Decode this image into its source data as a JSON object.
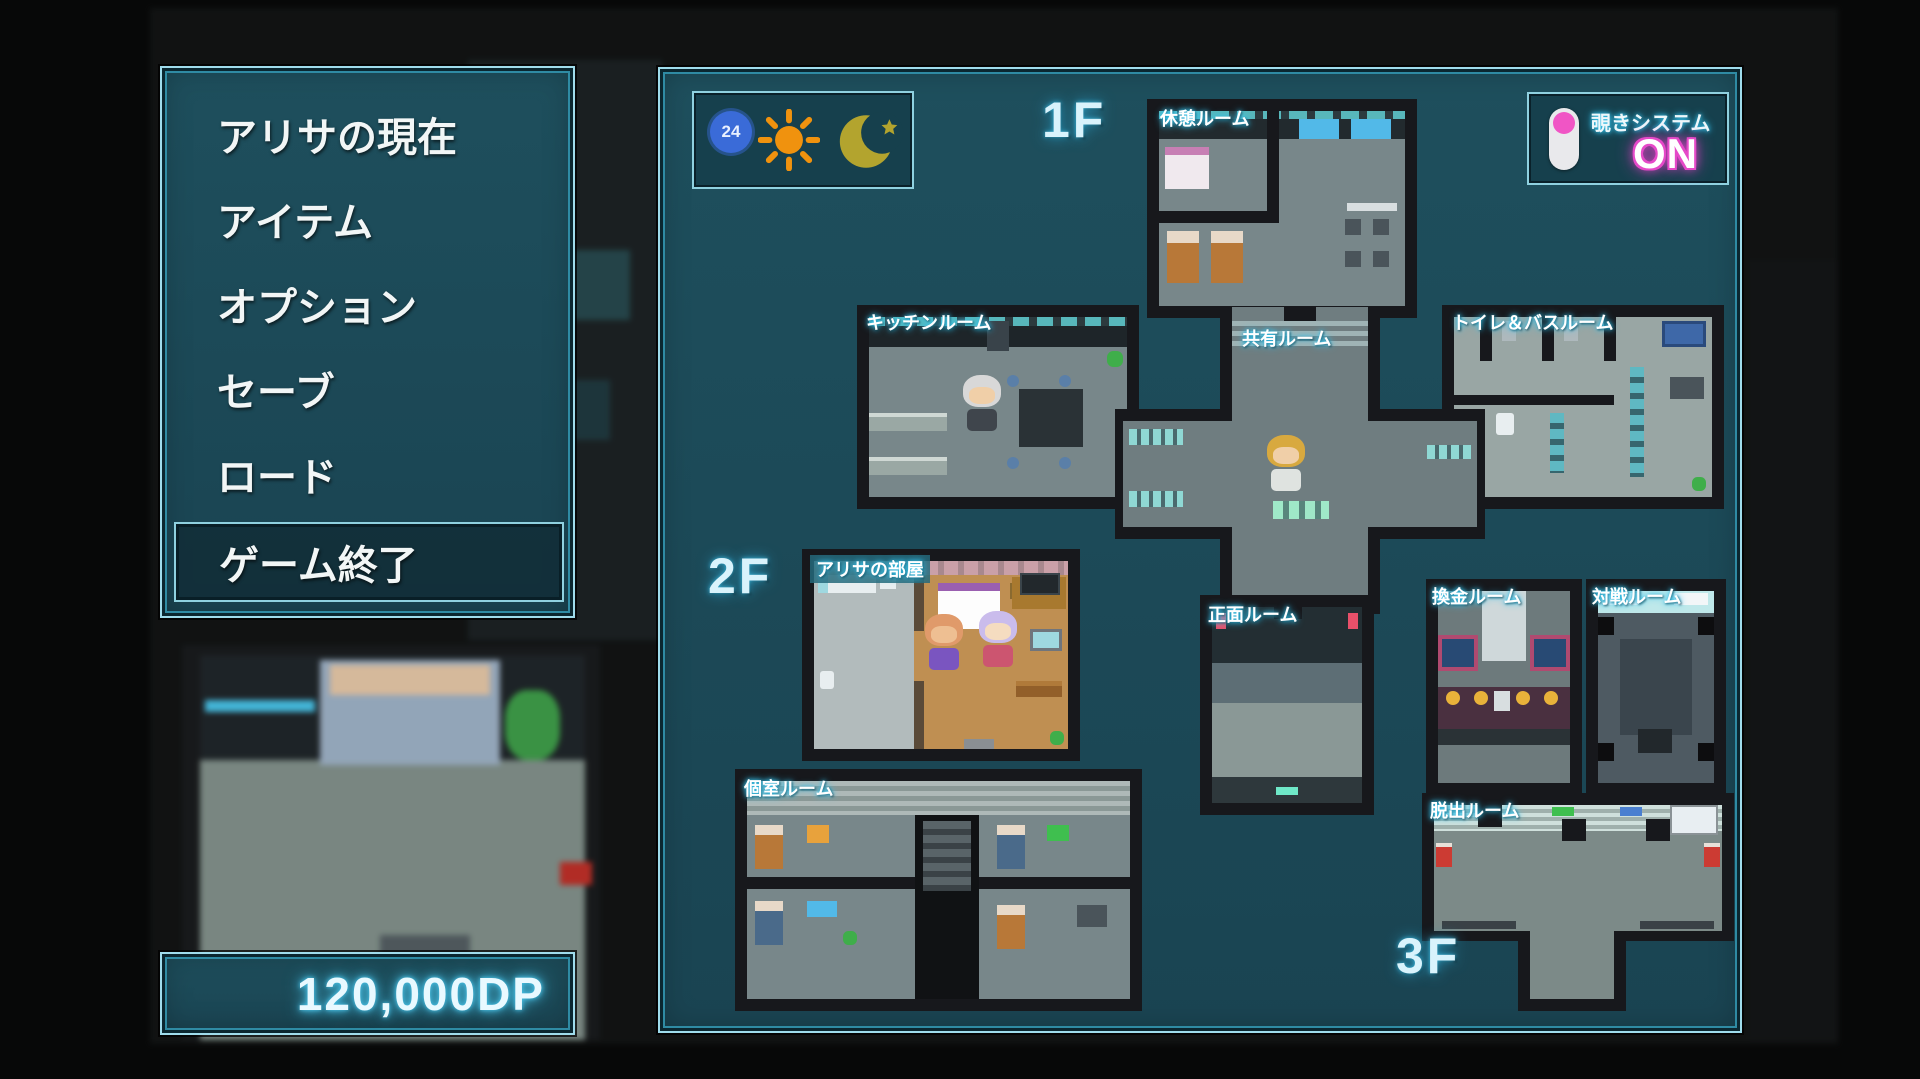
{
  "menu": {
    "items": [
      {
        "label": "アリサの現在",
        "selected": false
      },
      {
        "label": "アイテム",
        "selected": false
      },
      {
        "label": "オプション",
        "selected": false
      },
      {
        "label": "セーブ",
        "selected": false
      },
      {
        "label": "ロード",
        "selected": false
      },
      {
        "label": "ゲーム終了",
        "selected": true
      }
    ],
    "selected_index": 5
  },
  "currency": {
    "amount": "120,000DP"
  },
  "map": {
    "floors": {
      "f1": "1F",
      "f2": "2F",
      "f3": "3F"
    },
    "rooms": {
      "rest": "休憩ルーム",
      "kitchen": "キッチンルーム",
      "shared": "共有ルーム",
      "toilet_bath": "トイレ＆バスルーム",
      "front": "正面ルーム",
      "alisa": "アリサの部屋",
      "private": "個室ルーム",
      "exchange": "換金ルーム",
      "battle": "対戦ルーム",
      "escape": "脱出ルーム"
    },
    "time_panel": {
      "clock_text": "24",
      "icons": [
        "24-hour-clock-icon",
        "sun-icon",
        "moon-star-icon"
      ]
    },
    "peek_system": {
      "label": "覗きシステム",
      "state": "ON",
      "toggle_on": true
    },
    "characters": [
      {
        "name": "old-man",
        "room": "kitchen"
      },
      {
        "name": "blonde-player",
        "room": "shared"
      },
      {
        "name": "bald-man",
        "room": "alisa"
      },
      {
        "name": "alisa-girl",
        "room": "alisa"
      }
    ]
  },
  "colors": {
    "panel_background": "#1c4a57",
    "panel_border": "#8fd1e0",
    "cyan_glow": "#3fc3e8",
    "magenta_glow": "#f23fd0",
    "sun_orange": "#f0920e",
    "moon_olive": "#b3a42e",
    "toggle_pink": "#f055c5",
    "wall_dark": "#17181c",
    "floor_gray": "#78878a",
    "wood_floor": "#bf8f52"
  }
}
